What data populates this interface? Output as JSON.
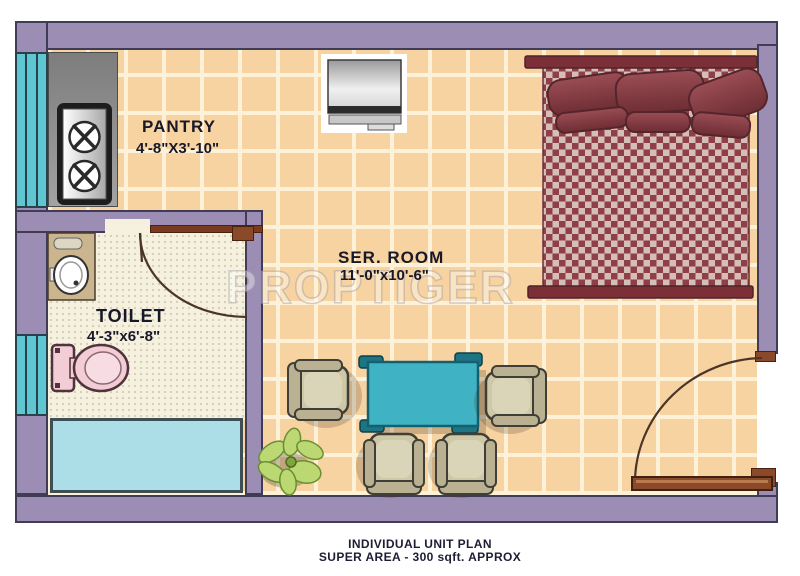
{
  "plan": {
    "watermark": "PROPTIGER",
    "rooms": [
      {
        "name": "PANTRY",
        "dims": "4'-8\"X3'-10\""
      },
      {
        "name": "TOILET",
        "dims": "4'-3\"x6'-8\""
      },
      {
        "name": "SER. ROOM",
        "dims": "11'-0\"x10'-6\""
      }
    ],
    "caption": {
      "line1": "INDIVIDUAL UNIT PLAN",
      "line2": "SUPER AREA - 300 sqft. APPROX"
    },
    "furniture": [
      "bed",
      "tv",
      "stove",
      "washbasin",
      "toilet-commode",
      "dining-table",
      "chair",
      "plant"
    ],
    "colors": {
      "wall_purple": "#9c8db4",
      "floor_tile": "#f6d3a0",
      "tile_grout": "#fdf2d8",
      "toilet_floor": "#f5f1de",
      "window_cyan": "#5fc6d2",
      "wash_area_cyan": "#abdee6",
      "table_teal": "#3fb3c3",
      "bed_maroon": "#8e3f47",
      "bed_frame": "#7b2f36",
      "chair_tan": "#c9c19e",
      "door_brown": "#7b3a20",
      "label_text": "#181828"
    }
  }
}
